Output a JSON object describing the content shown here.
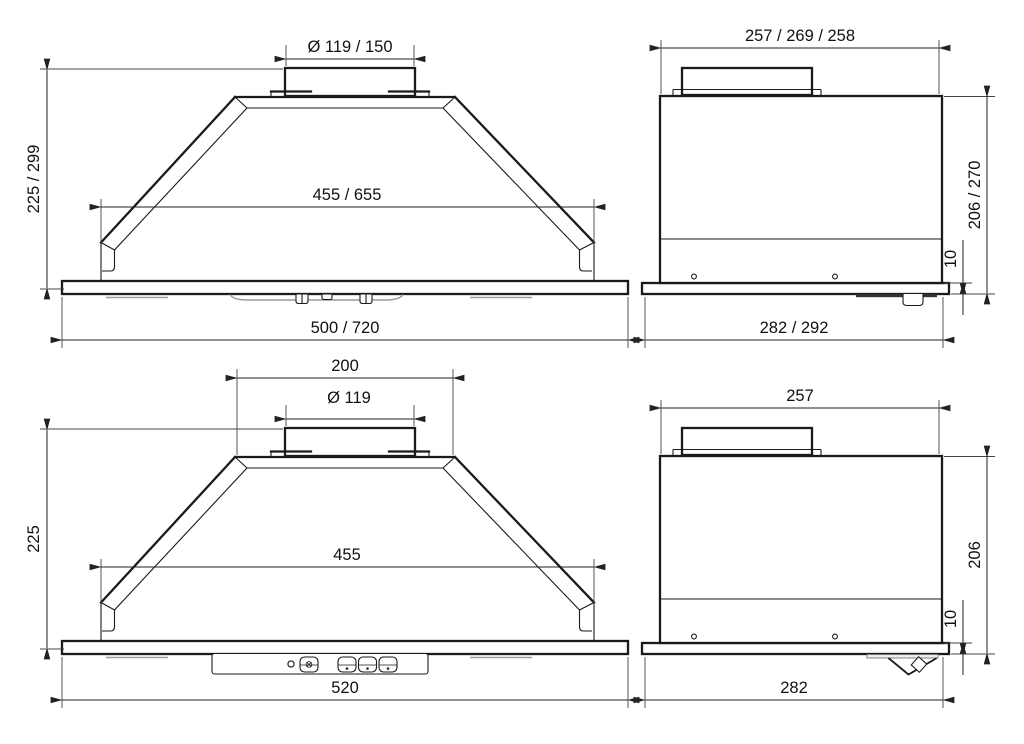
{
  "colors": {
    "background": "#ffffff",
    "line": "#1a1a1a",
    "dimension_text": "#111111"
  },
  "views": {
    "front_large": {
      "dims": {
        "duct_diameter": "Ø 119 / 150",
        "height": "225 / 299",
        "inner_width": "455 / 655",
        "overall_width": "500 / 720"
      }
    },
    "side_large": {
      "dims": {
        "top_depth": "257 / 269 / 258",
        "height": "206 / 270",
        "plate_thickness": "10",
        "overall_depth": "282 / 292"
      }
    },
    "front_small": {
      "dims": {
        "top_width": "200",
        "duct_diameter": "Ø 119",
        "height": "225",
        "inner_width": "455",
        "overall_width": "520"
      },
      "controls": {
        "indicator": "led-indicator",
        "buttons": [
          "light-button",
          "speed-button-1",
          "speed-button-2",
          "speed-button-3"
        ]
      }
    },
    "side_small": {
      "dims": {
        "top_depth": "257",
        "height": "206",
        "plate_thickness": "10",
        "overall_depth": "282"
      }
    }
  }
}
